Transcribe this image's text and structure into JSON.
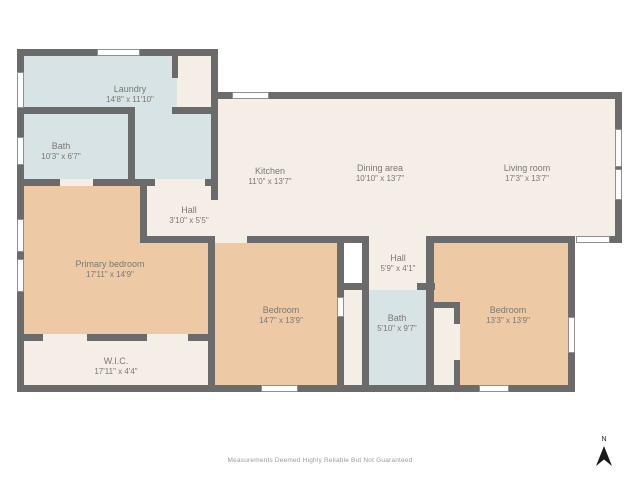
{
  "palette": {
    "wall": "#6b6b6b",
    "room_cream": "#f4eee7",
    "room_tan": "#edcaa5",
    "room_blue": "#d7e3e5",
    "label_text": "#7d7770",
    "footer_text": "#9b9b9b",
    "compass": "#1a1a1a"
  },
  "rooms": [
    {
      "id": "laundry",
      "name": "Laundry",
      "dims": "14'8\" x 11'10\""
    },
    {
      "id": "bath-upper",
      "name": "Bath",
      "dims": "10'3\" x 6'7\""
    },
    {
      "id": "kitchen",
      "name": "Kitchen",
      "dims": "11'0\" x 13'7\""
    },
    {
      "id": "dining-area",
      "name": "Dining area",
      "dims": "10'10\" x 13'7\""
    },
    {
      "id": "living-room",
      "name": "Living room",
      "dims": "17'3\" x 13'7\""
    },
    {
      "id": "hall-upper",
      "name": "Hall",
      "dims": "3'10\" x 5'5\""
    },
    {
      "id": "primary-bedroom",
      "name": "Primary bedroom",
      "dims": "17'11\" x 14'9\""
    },
    {
      "id": "bedroom-middle",
      "name": "Bedroom",
      "dims": "14'7\" x 13'9\""
    },
    {
      "id": "hall-lower",
      "name": "Hall",
      "dims": "5'9\" x 4'1\""
    },
    {
      "id": "bath-lower",
      "name": "Bath",
      "dims": "5'10\" x 9'7\""
    },
    {
      "id": "bedroom-right",
      "name": "Bedroom",
      "dims": "13'3\" x 13'9\""
    },
    {
      "id": "wic",
      "name": "W.I.C.",
      "dims": "17'11\" x 4'4\""
    }
  ],
  "footer": {
    "disclaimer": "Measurements Deemed Highly Reliable But Not Guaranteed"
  },
  "compass": {
    "label": "N"
  }
}
